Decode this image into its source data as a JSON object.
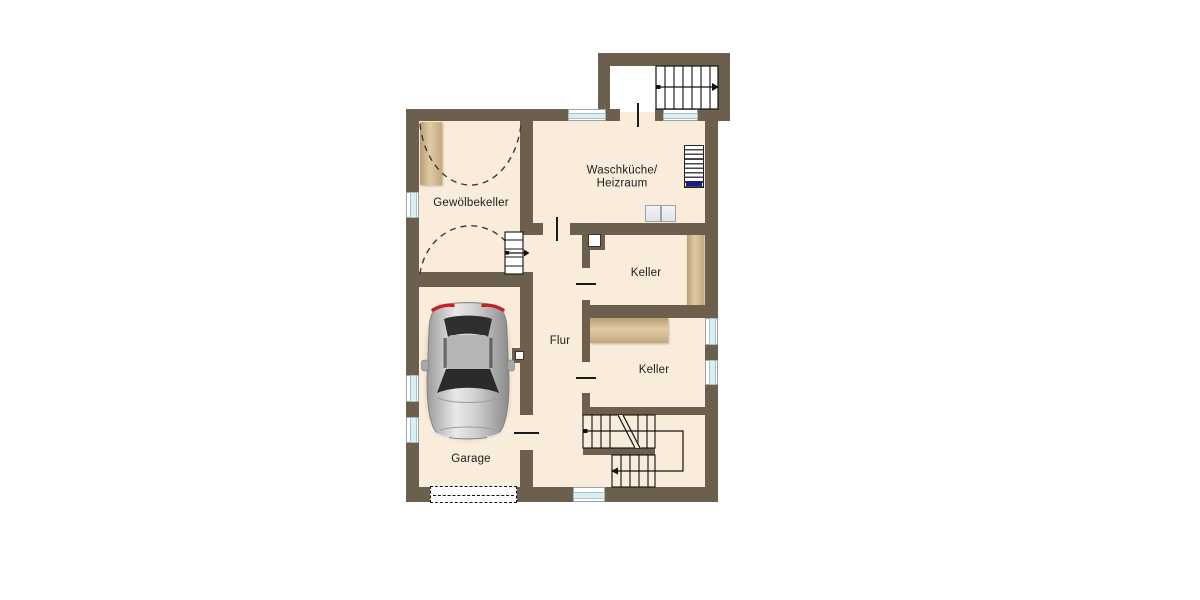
{
  "floor_plan": {
    "rooms": [
      {
        "id": "gewoelbekeller",
        "label": "Gewölbekeller"
      },
      {
        "id": "waschkueche-heizraum",
        "label_line1": "Waschküche/",
        "label_line2": "Heizraum"
      },
      {
        "id": "keller-1",
        "label": "Keller"
      },
      {
        "id": "keller-2",
        "label": "Keller"
      },
      {
        "id": "flur",
        "label": "Flur"
      },
      {
        "id": "garage",
        "label": "Garage"
      }
    ],
    "icons": [
      "car-top-view-icon",
      "heater-icon",
      "washer-dryer-icon",
      "shelf-icon",
      "exterior-stairs-icon",
      "main-stairs-icon",
      "nook-stairs-icon",
      "garage-door-icon",
      "window-icon",
      "chimney-icon",
      "vault-arc-icon",
      "door-opening-tick-icon",
      "direction-arrow-icon"
    ],
    "colors": {
      "wall": "#6c5f4d",
      "floor": "#f9ecda",
      "window_glass": "#d8f0f4",
      "shelf_wood": "#cdb186",
      "heater_accent": "#1c1c86",
      "car_taillight": "#c42222",
      "background": "#ffffff",
      "line": "#1a1a1a"
    }
  }
}
